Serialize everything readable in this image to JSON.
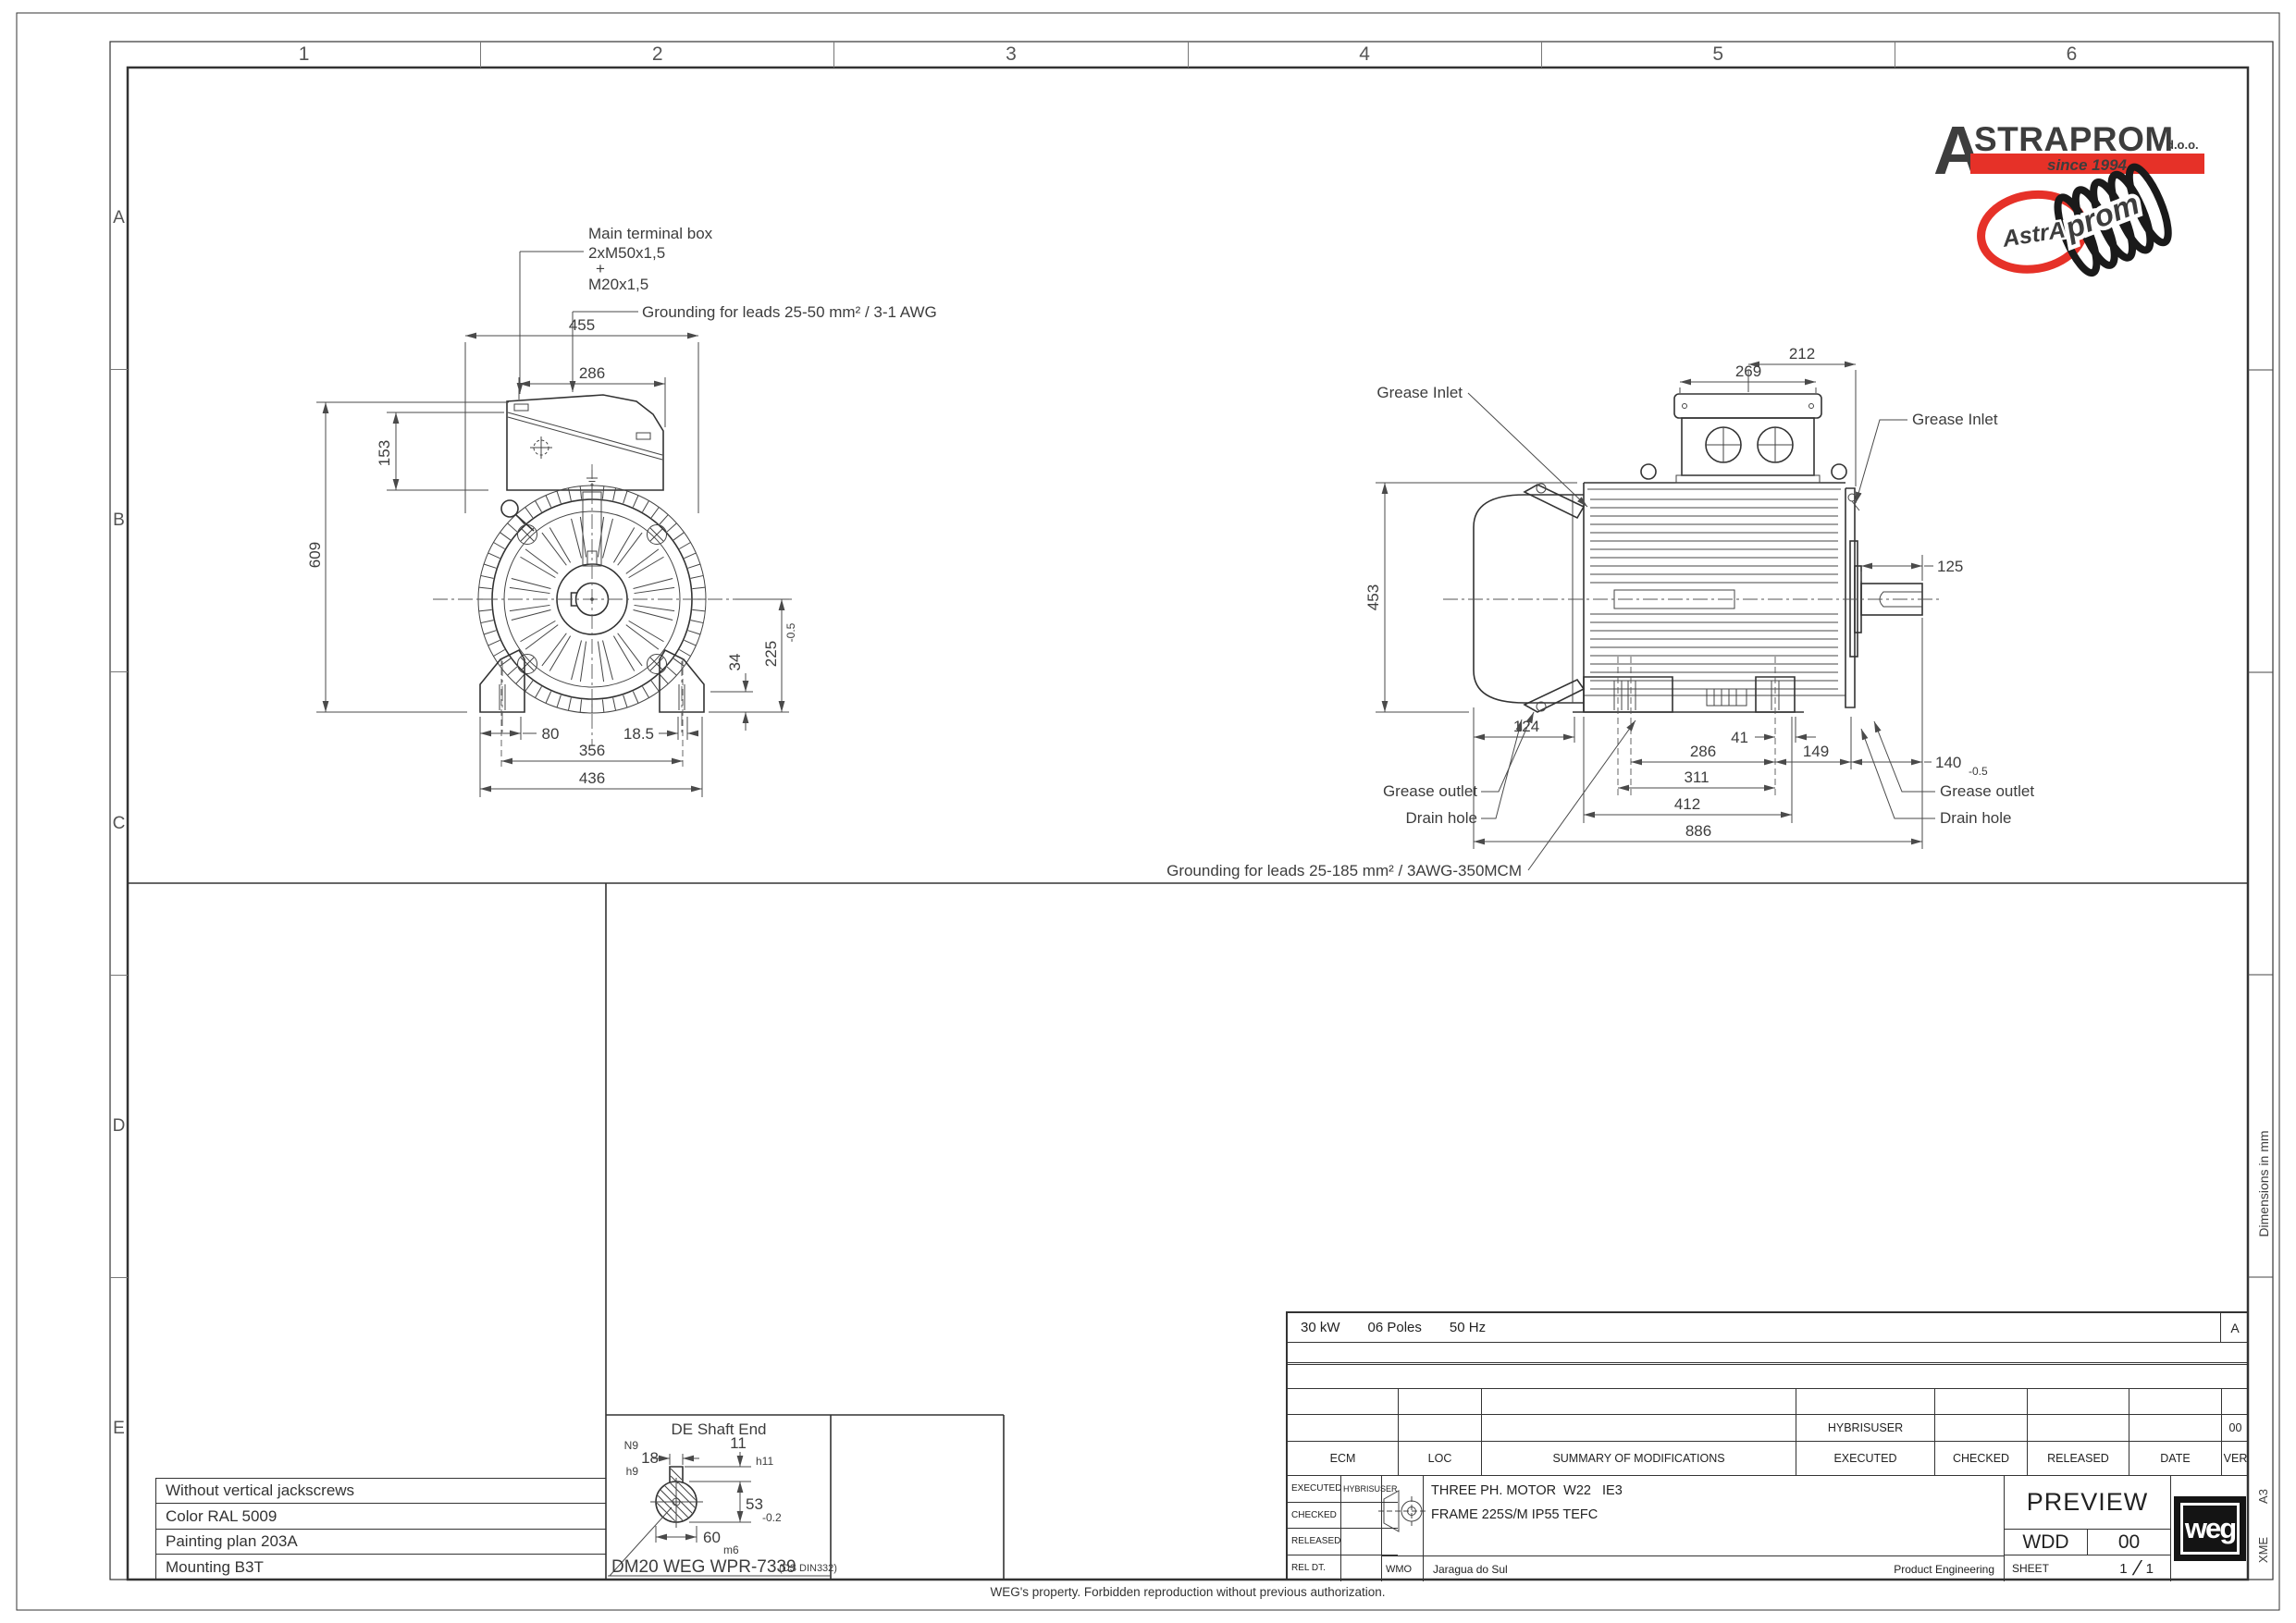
{
  "frame": {
    "columns": [
      "1",
      "2",
      "3",
      "4",
      "5",
      "6"
    ],
    "rows": [
      "A",
      "B",
      "C",
      "D",
      "E"
    ],
    "dimensions_note": "Dimensions in mm",
    "format": "A3",
    "format_code": "XME",
    "property_note": "WEG's property. Forbidden reproduction without previous authorization."
  },
  "front_view": {
    "labels": {
      "terminal_box_1": "Main terminal box",
      "terminal_box_2": "2xM50x1,5",
      "terminal_box_3": "+",
      "terminal_box_4": "M20x1,5",
      "grounding": "Grounding for leads 25-50 mm² / 3-1 AWG"
    },
    "dims": {
      "overall_width": "455",
      "box_width": "286",
      "box_height": "153",
      "overall_height": "609",
      "shaft_height": "225",
      "shaft_height_tol": "-0.5",
      "foot_height": "34",
      "foot_hole": "80",
      "foot_edge": "18.5",
      "feet_holes_span": "356",
      "feet_width": "436"
    }
  },
  "side_view": {
    "labels": {
      "grease_inlet": "Grease Inlet",
      "grease_outlet": "Grease outlet",
      "drain_hole": "Drain hole",
      "grounding": "Grounding for leads 25-185 mm² / 3AWG-350MCM"
    },
    "dims": {
      "box_top": "212",
      "box_width": "269",
      "body_height": "453",
      "shaft_length": "125",
      "drain_offset": "124",
      "foot_to_shield": "41",
      "feet_span_s": "286",
      "shield_to_shaft": "149",
      "feet_span_m": "311",
      "feet_length": "412",
      "overall_length": "886",
      "shaft_offset": "140",
      "shaft_offset_tol": "-0.5"
    }
  },
  "shaft_detail": {
    "title": "DE Shaft End",
    "key_width_tol_top": "N9",
    "key_width": "18",
    "key_width_tol_bottom": "h9",
    "key_height": "11",
    "key_height_tol": "h11",
    "key_seat": "53",
    "key_seat_tol": "-0.2",
    "diameter": "60",
    "diameter_tol": "m6",
    "center_hole": "DM20 WEG WPR-7339",
    "center_hole_std": "(DS DIN332)"
  },
  "notes": {
    "rows": [
      "Without vertical jackscrews",
      "Color RAL 5009",
      "Painting plan 203A",
      "Mounting B3T"
    ]
  },
  "logo": {
    "initial": "A",
    "name": "STRAPROM",
    "suffix": "d.o.o.",
    "tagline": "since 1994",
    "badge_text_1": "AstrA",
    "badge_text_2": "prom",
    "red": "#e63128"
  },
  "title_block": {
    "rating": {
      "power": "30 kW",
      "poles": "06 Poles",
      "frequency": "50 Hz",
      "revision": "A"
    },
    "mod_table": {
      "headers": [
        "ECM",
        "LOC",
        "SUMMARY OF MODIFICATIONS",
        "EXECUTED",
        "CHECKED",
        "RELEASED",
        "DATE",
        "VER"
      ],
      "entry_executed": "HYBRISUSER",
      "entry_ver": "00"
    },
    "sign_rows": [
      {
        "label": "EXECUTED",
        "value": "HYBRISUSER"
      },
      {
        "label": "CHECKED",
        "value": ""
      },
      {
        "label": "RELEASED",
        "value": ""
      },
      {
        "label": "REL DT.",
        "value": ""
      }
    ],
    "description_1": "THREE PH. MOTOR  W22   IE3",
    "description_2": "FRAME 225S/M IP55 TEFC",
    "origin_code": "WMO",
    "site": "Jaragua do Sul",
    "department": "Product Engineering",
    "status": "PREVIEW",
    "doc_type": "WDD",
    "doc_version": "00",
    "sheet_label": "SHEET",
    "sheet_number": "1",
    "sheet_total": "1",
    "weg_logo": "weg"
  }
}
